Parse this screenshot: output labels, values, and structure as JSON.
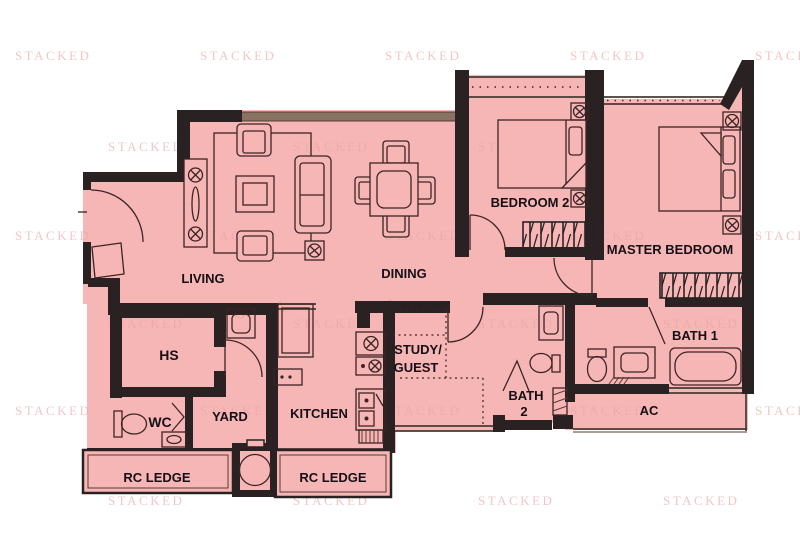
{
  "plan": {
    "rooms": {
      "living": "LIVING",
      "dining": "DINING",
      "bedroom2": "BEDROOM 2",
      "master_bedroom": "MASTER BEDROOM",
      "hs": "HS",
      "wc": "WC",
      "yard": "YARD",
      "kitchen": "KITCHEN",
      "study_line1": "STUDY/",
      "study_line2": "GUEST",
      "bath2_line1": "BATH",
      "bath2_line2": "2",
      "bath1": "BATH 1",
      "ac": "AC",
      "rc_ledge_left": "RC LEDGE",
      "rc_ledge_right": "RC LEDGE"
    },
    "watermark": {
      "text": "STACKED",
      "letters": [
        "J",
        "O",
        "A",
        "A",
        "S"
      ]
    },
    "colors": {
      "floor": "#f7b6b6",
      "wall": "#2a2123",
      "furniture_line": "#3d2424",
      "window_band": "#8a7262",
      "label": "#141016",
      "watermark": "#e9a4a4",
      "background": "#ffffff"
    }
  }
}
